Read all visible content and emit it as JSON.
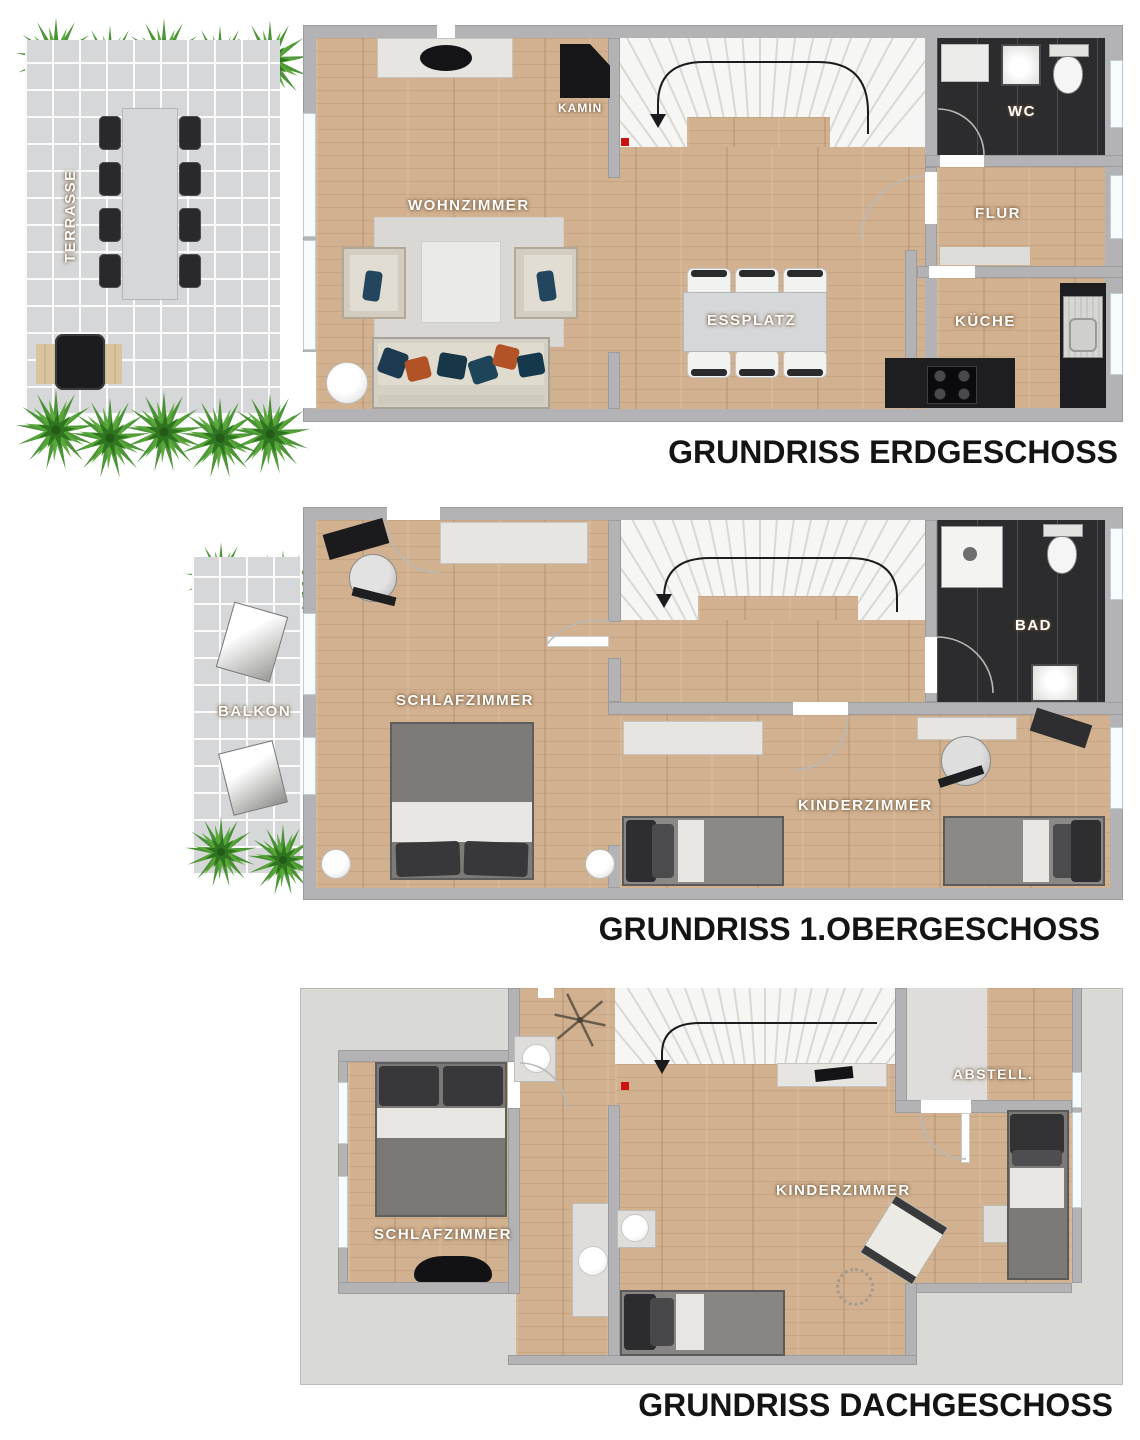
{
  "meta": {
    "document_type": "floorplan"
  },
  "titles": {
    "erdgeschoss": "GRUNDRISS ERDGESCHOSS",
    "obergeschoss": "GRUNDRISS 1.OBERGESCHOSS",
    "dachgeschoss": "GRUNDRISS DACHGESCHOSS"
  },
  "floors": {
    "eg": {
      "rooms": {
        "terrasse": "TERRASSE",
        "wohnzimmer": "WOHNZIMMER",
        "kamin": "KAMIN",
        "essplatz": "ESSPLATZ",
        "kueche": "KÜCHE",
        "flur": "FLUR",
        "wc": "WC"
      }
    },
    "og": {
      "rooms": {
        "balkon": "BALKON",
        "schlafzimmer": "SCHLAFZIMMER",
        "kinderzimmer": "KINDERZIMMER",
        "bad": "BAD"
      }
    },
    "dg": {
      "rooms": {
        "schlafzimmer": "SCHLAFZIMMER",
        "kinderzimmer": "KINDERZIMMER",
        "abstell": "ABSTELL."
      }
    }
  },
  "colors": {
    "wood": "#d2b190",
    "tile": "#d6d7d8",
    "wall": "#b3b3b5",
    "dark_room": "#2c2c2e",
    "roof": "#d9d9d6",
    "stairs": "#f6f6f4",
    "marker_red": "#cc1111",
    "plant_green": "#4a9630",
    "title_text": "#141414",
    "label_text": "#ffffff"
  }
}
